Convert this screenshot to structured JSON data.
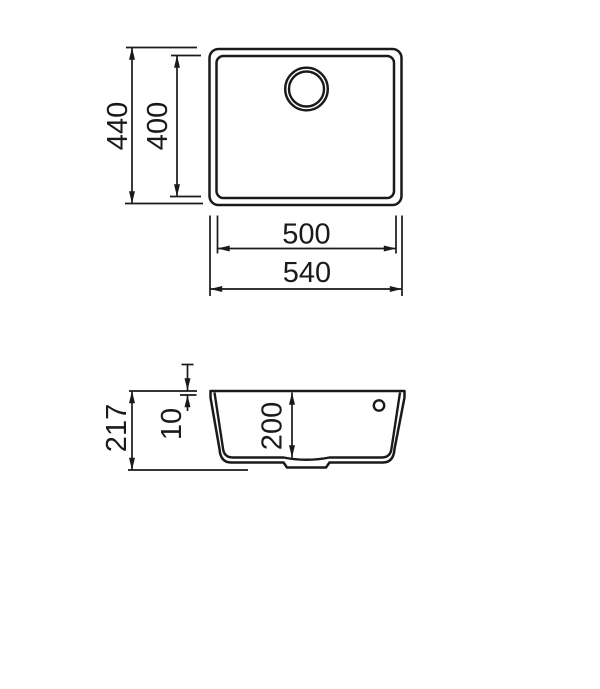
{
  "page": {
    "background": "#ffffff",
    "line_color": "#1a1a1a"
  },
  "top_view": {
    "dims": {
      "overall_depth": "440",
      "inner_depth": "400",
      "inner_width": "500",
      "overall_width": "540"
    }
  },
  "side_view": {
    "dims": {
      "overall_height": "217",
      "rim_thickness": "10",
      "bowl_depth": "200"
    }
  }
}
